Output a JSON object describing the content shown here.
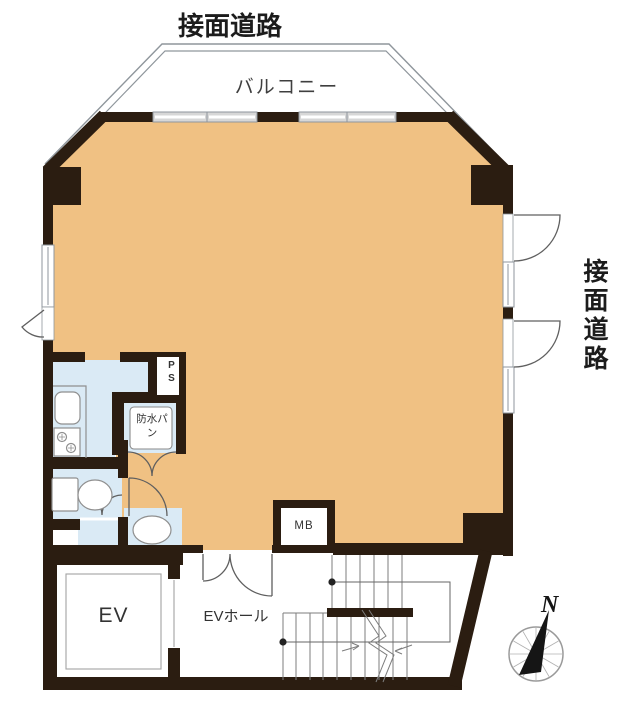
{
  "meta": {
    "kind": "floor-plan"
  },
  "labels": {
    "road_top": "接面道路",
    "road_right": "接面道路",
    "balcony": "バルコニー",
    "pipe_space": "PS",
    "waterproof_pan": "防水パン",
    "mail_box": "MB",
    "elevator": "EV",
    "elevator_hall": "EVホール",
    "north": "N"
  },
  "colors": {
    "floor": "#F0C183",
    "wet": "#DAEAF5",
    "wall": "#2B1D11",
    "frame": "#8F969C",
    "winfill": "#D7D7D7",
    "text": "#1C1C1C"
  }
}
